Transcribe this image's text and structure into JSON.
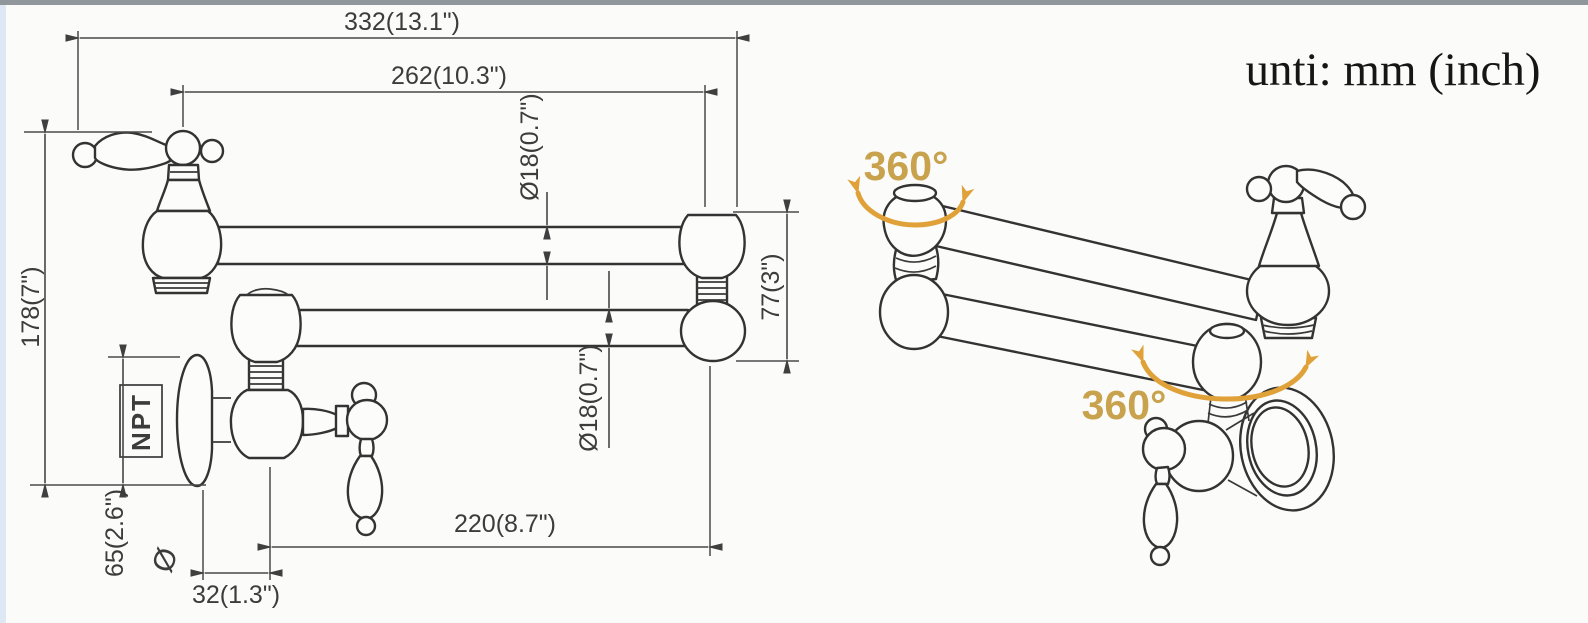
{
  "unit_note": "unti: mm (inch)",
  "front_view": {
    "dim_overall_length": "332(13.1\")",
    "dim_arm_length": "262(10.3\")",
    "dim_upper_arm_diameter": "Ø18(0.7\")",
    "dim_lower_arm_diameter": "Ø18(0.7\")",
    "dim_overall_height": "178(7\")",
    "dim_joint_height": "77(3\")",
    "dim_spout_reach": "220(8.7\")",
    "dim_wall_offset": "32(1.3\")",
    "dim_flange_diameter": "65(2.6\")",
    "flange_diameter_symbol": "Ø",
    "thread_label": "NPT"
  },
  "perspective_view": {
    "rotation_label_upper": "360°",
    "rotation_label_lower": "360°"
  },
  "colors": {
    "line": "#333333",
    "dimension": "#474747",
    "accent_text": "#c8a24d",
    "accent_arrow": "#e0a138",
    "top_band": "#8f969c",
    "left_band": "#dde8f4",
    "background": "#fbfbfa"
  }
}
